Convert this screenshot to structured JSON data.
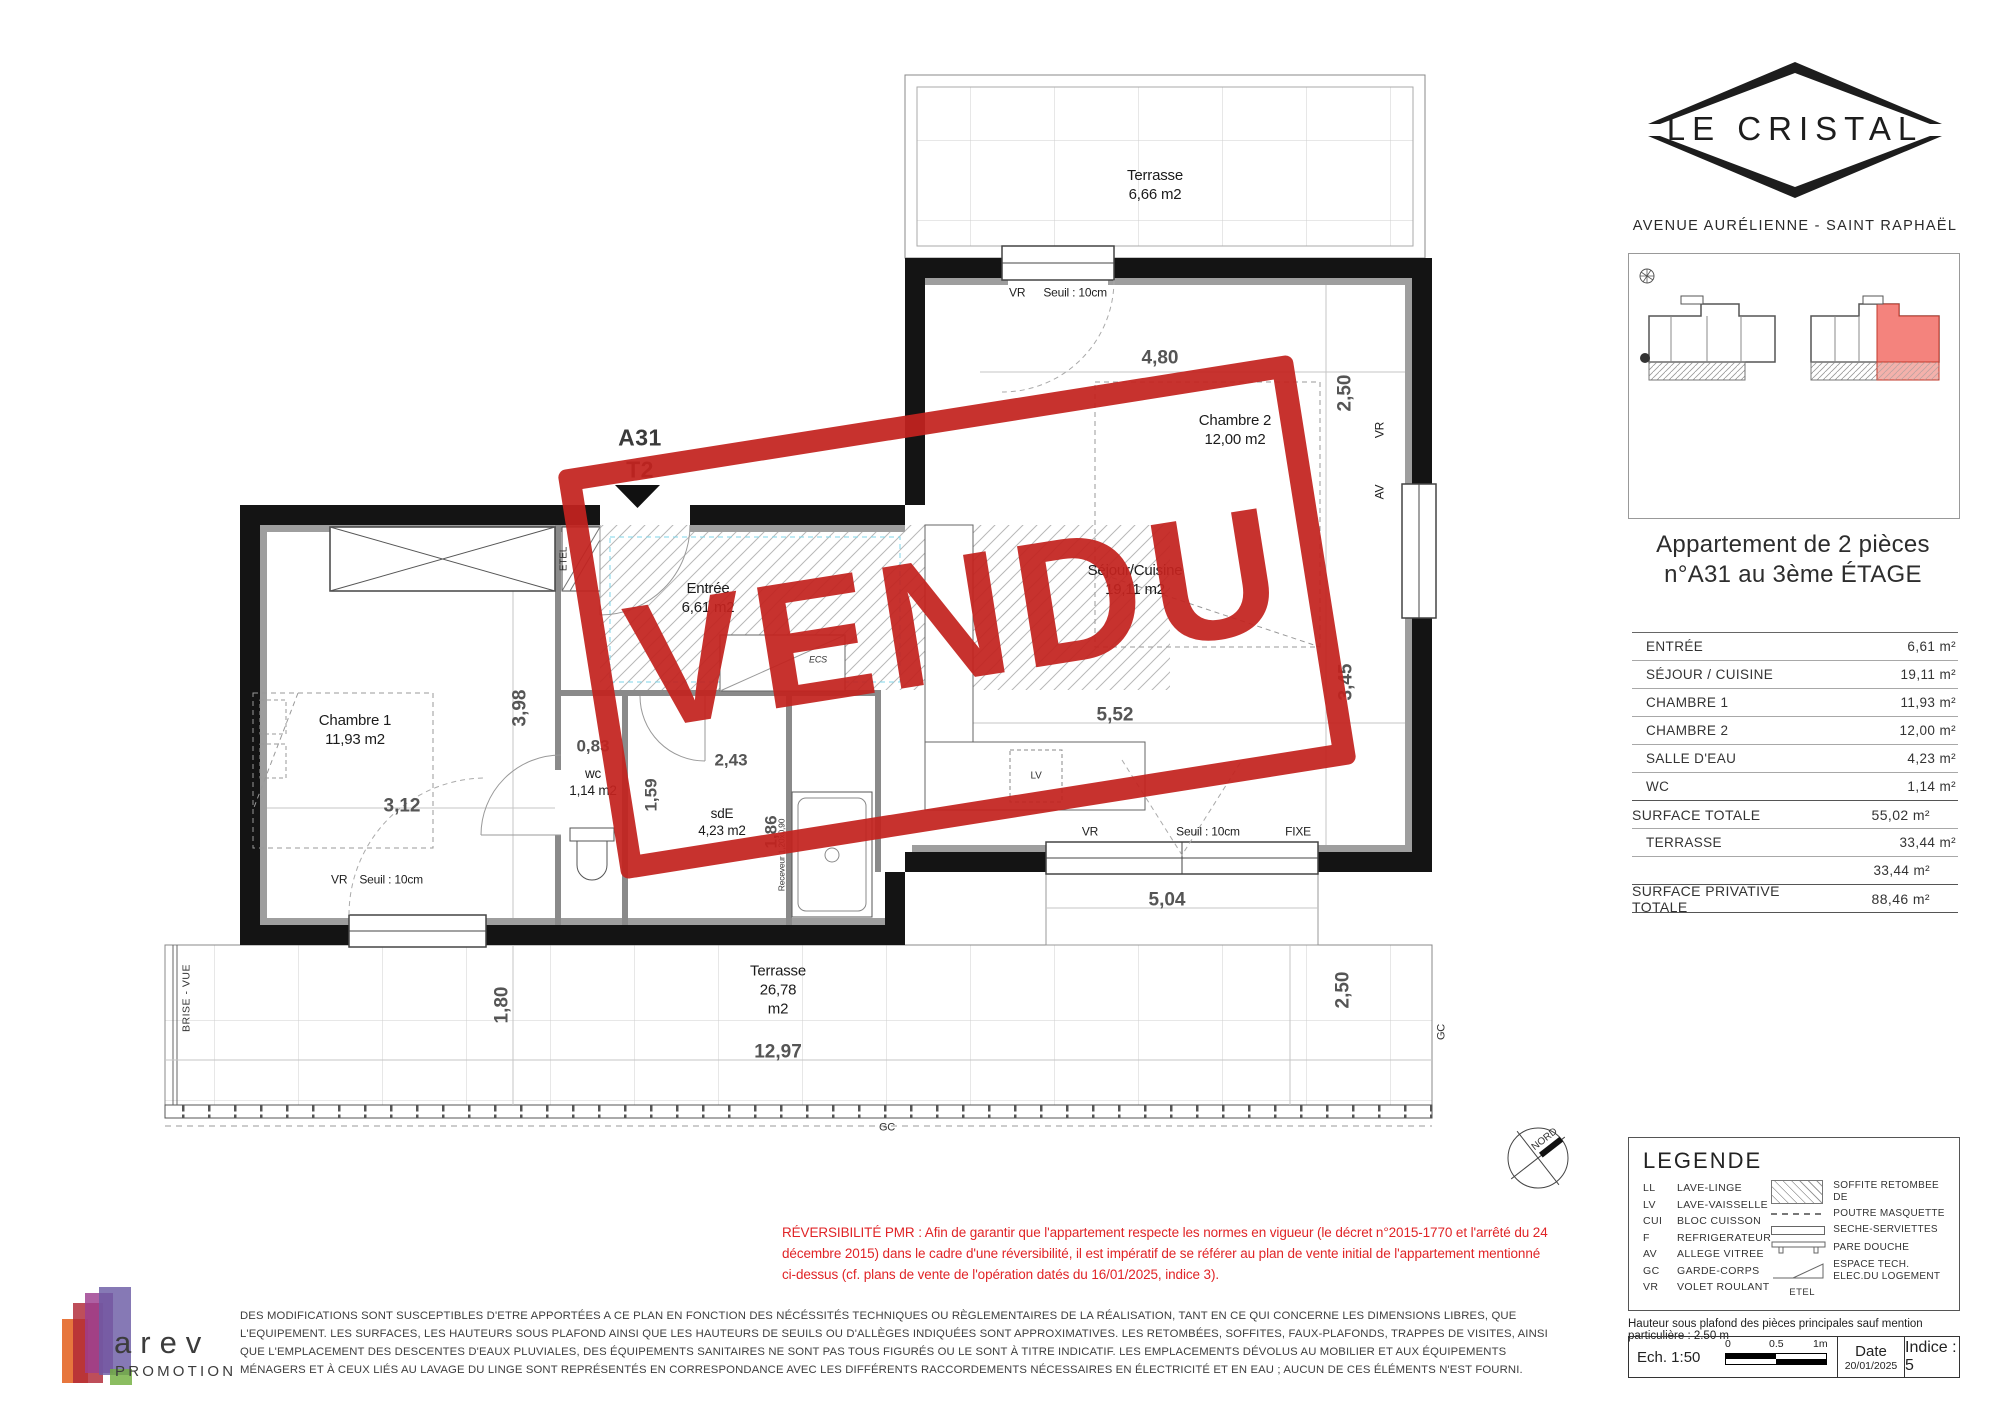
{
  "branding": {
    "title": "LE CRISTAL",
    "address": "AVENUE AURÉLIENNE - SAINT RAPHAËL"
  },
  "apartment": {
    "title_line1": "Appartement de 2 pièces",
    "title_line2": "n°A31 au 3ème ÉTAGE"
  },
  "surface_table": {
    "rows": [
      {
        "label": "ENTRÉE",
        "value": "6,61 m²"
      },
      {
        "label": "SÉJOUR / CUISINE",
        "value": "19,11 m²"
      },
      {
        "label": "CHAMBRE 1",
        "value": "11,93 m²"
      },
      {
        "label": "CHAMBRE 2",
        "value": "12,00 m²"
      },
      {
        "label": "SALLE D'EAU",
        "value": "4,23 m²"
      },
      {
        "label": "WC",
        "value": "1,14 m²"
      },
      {
        "label": "SURFACE TOTALE",
        "value": "55,02 m²"
      },
      {
        "label": "TERRASSE",
        "value": "33,44 m²"
      },
      {
        "label": "",
        "value": "33,44 m²"
      },
      {
        "label": "SURFACE PRIVATIVE TOTALE",
        "value": "88,46 m²"
      }
    ]
  },
  "plan": {
    "stamp": "VENDU",
    "unit": "A31",
    "type": "T2",
    "terrace_top": {
      "name": "Terrasse",
      "area": "6,66 m2"
    },
    "terrace_bottom": {
      "name": "Terrasse",
      "area": "26,78 m2",
      "dim_w": "12,97",
      "dim_h": "1,80",
      "dim_right": "2,50",
      "dim_top": "5,04"
    },
    "rooms": {
      "entree": {
        "name": "Entrée",
        "area": "6,61 m2"
      },
      "sejour": {
        "name": "Séjour/Cuisine",
        "area": "19,11 m2",
        "dim_w": "5,52",
        "dim_h": "3,45"
      },
      "chambre1": {
        "name": "Chambre 1",
        "area": "11,93 m2",
        "dim_w": "3,12",
        "dim_h": "3,98"
      },
      "chambre2": {
        "name": "Chambre 2",
        "area": "12,00 m2",
        "dim_w": "4,80",
        "dim_h": "2,50"
      },
      "wc": {
        "name": "wc",
        "area": "1,14 m2",
        "dim_w": "0,83",
        "dim_h": "1,59"
      },
      "sde": {
        "name": "sdE",
        "area": "4,23 m2",
        "dim_w": "2,43",
        "dim_h": "1,86"
      }
    },
    "annotations": {
      "vr": "VR",
      "seuil": "Seuil : 10cm",
      "fixe": "FIXE",
      "av": "AV",
      "gc": "GC",
      "etel": "ETEL",
      "ecs": "ECS",
      "lv": "LV",
      "brise_vue": "BRISE - VUE",
      "receveur": "Receveur 1,20x0,90",
      "nord": "NORD"
    }
  },
  "legend": {
    "title": "LEGENDE",
    "abbreviations": [
      {
        "code": "LL",
        "label": "LAVE-LINGE"
      },
      {
        "code": "LV",
        "label": "LAVE-VAISSELLE"
      },
      {
        "code": "CUI",
        "label": "BLOC CUISSON"
      },
      {
        "code": "F",
        "label": "REFRIGERATEUR"
      },
      {
        "code": "AV",
        "label": "ALLEGE VITREE"
      },
      {
        "code": "GC",
        "label": "GARDE-CORPS"
      },
      {
        "code": "VR",
        "label": "VOLET ROULANT"
      }
    ],
    "symbols": [
      {
        "icon": "hatch-swatch",
        "label": "SOFFITE RETOMBEE DE"
      },
      {
        "icon": "dashed-line",
        "label": "POUTRE MASQUETTE"
      },
      {
        "icon": "towel-bar",
        "label": "SECHE-SERVIETTES"
      },
      {
        "icon": "shower-screen",
        "label": "PARE DOUCHE"
      },
      {
        "icon": "etel-triangle",
        "label": "ESPACE TECH. ELEC.DU LOGEMENT",
        "caption": "ETEL"
      }
    ]
  },
  "notes": {
    "pmr_lines": [
      "RÉVERSIBILITÉ PMR : Afin de garantir que l'appartement respecte les normes en vigueur (le décret n°2015-1770 et l'arrêté du 24",
      "décembre 2015) dans le cadre d'une réversibilité, il est impératif de se référer au plan de vente initial de l'appartement mentionné",
      "ci-dessus (cf. plans de vente de l'opération datés du 16/01/2025, indice 3)."
    ],
    "disclaimer_lines": [
      "DES MODIFICATIONS SONT SUSCEPTIBLES D'ETRE APPORTÉES A CE PLAN EN FONCTION DES NÉCÉSSITÉS TECHNIQUES OU RÈGLEMENTAIRES DE LA RÉALISATION, TANT EN CE QUI CONCERNE LES DIMENSIONS LIBRES, QUE",
      "L'EQUIPEMENT. LES SURFACES, LES HAUTEURS SOUS PLAFOND AINSI QUE LES HAUTEURS DE SEUILS OU D'ALLÈGES INDIQUÉES SONT APPROXIMATIVES. LES RETOMBÉES, SOFFITES, FAUX-PLAFONDS, TRAPPES DE VISITES, AINSI",
      "QUE L'EMPLACEMENT DES DESCENTES D'EAUX PLUVIALES, DES ÉQUIPEMENTS SANITAIRES NE SONT PAS TOUS FIGURÉS OU LE SONT À TITRE INDICATIF. LES EMPLACEMENTS DÉVOLUS AU MOBILIER ET AUX ÉQUIPEMENTS",
      "MÉNAGERS ET À CEUX LIÉS AU LAVAGE DU LINGE SONT REPRÉSENTÉS EN CORRESPONDANCE AVEC LES DIFFÉRENTS RACCORDEMENTS NÉCESSAIRES EN ÉLECTRICITÉ ET EN EAU ; AUCUN DE CES ÉLÉMENTS N'EST FOURNI."
    ],
    "ceiling": "Hauteur sous plafond des pièces principales sauf mention particulière : 2.50 m"
  },
  "titleblock": {
    "scale": "Ech. 1:50",
    "tick0": "0",
    "tick1": "0.5",
    "tick2": "1m",
    "date_label": "Date",
    "date": "20/01/2025",
    "indice": "Indice : 5"
  },
  "publisher": {
    "name": "arev",
    "sub": "PROMOTION"
  },
  "colors": {
    "stamp_red": "#c3231f",
    "highlight": "#f4837d",
    "pmr_red": "#e02427"
  }
}
